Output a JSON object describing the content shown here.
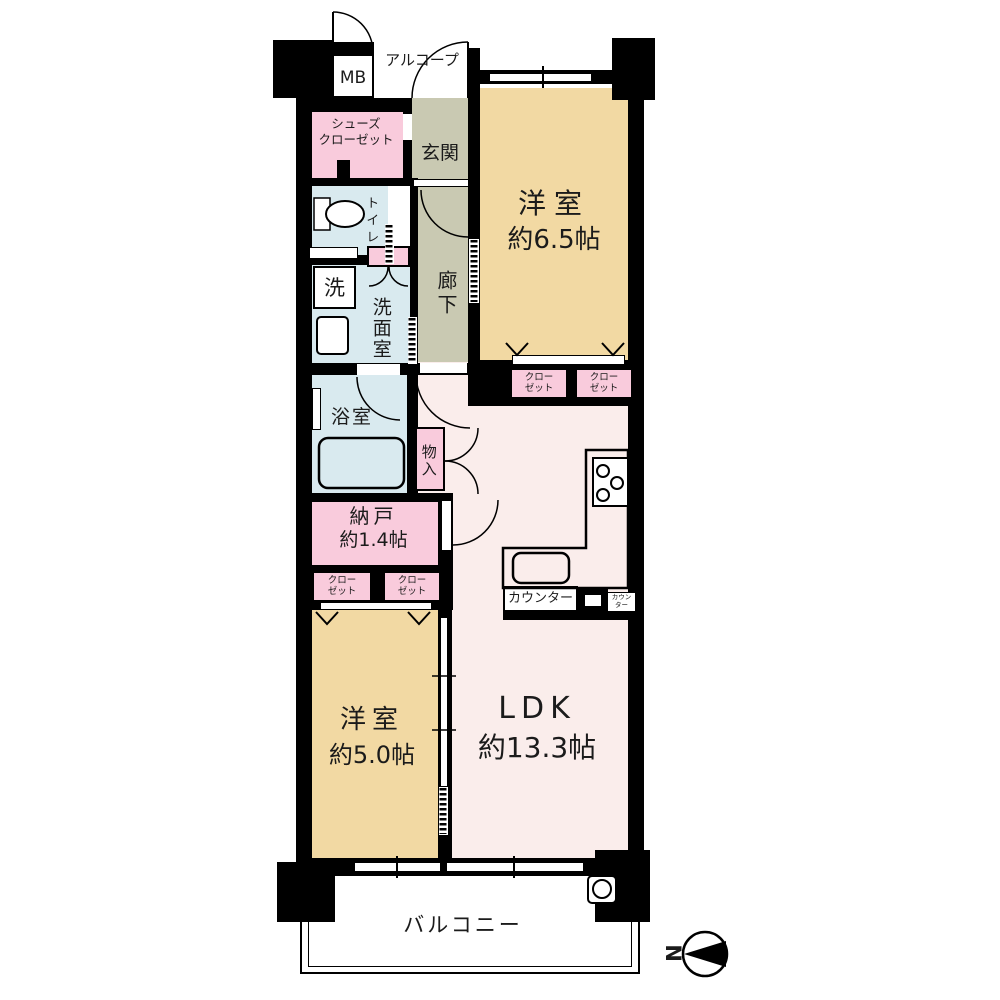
{
  "plan": {
    "mb": "MB",
    "alcove": "アルコープ",
    "shoes_closet": {
      "line1": "シューズ",
      "line2": "クローゼット"
    },
    "entrance": "玄関",
    "toilet": "トイレ",
    "hallway": "廊下",
    "western_room_1": {
      "name": "洋室",
      "size": "約6.5帖"
    },
    "closet": {
      "line1": "クロー",
      "line2": "ゼット"
    },
    "laundry": "洗",
    "washroom": "洗面室",
    "bathroom": "浴室",
    "storage": "物入",
    "storeroom": {
      "name": "納戸",
      "size": "約1.4帖"
    },
    "western_room_2": {
      "name": "洋室",
      "size": "約5.0帖"
    },
    "ldk": {
      "name": "LDK",
      "size": "約13.3帖"
    },
    "counter": "カウンター",
    "counter_small": {
      "line1": "カウン",
      "line2": "ター"
    },
    "balcony": "バルコニー",
    "compass_north": "N"
  },
  "colors": {
    "wall": "#000000",
    "western_room": "#F2D9A3",
    "ldk": "#FAEDEB",
    "wet_area": "#D9EAEF",
    "closet_pink": "#F9CBDC",
    "hallway": "#C9C9B2",
    "balcony": "#FFFFFF"
  }
}
